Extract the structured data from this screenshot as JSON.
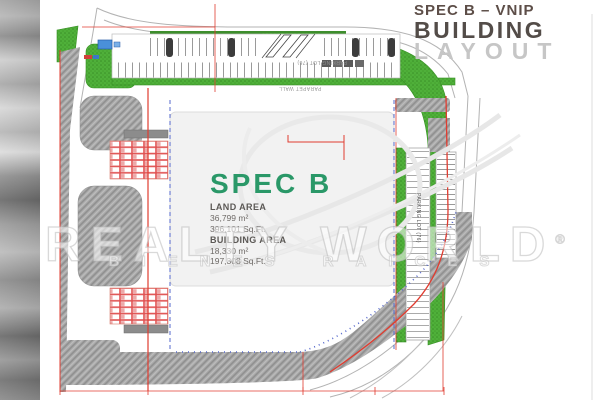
{
  "header": {
    "line1": "SPEC B – VNIP",
    "line2": "BUILDING",
    "line3": "LAYOUT"
  },
  "building_info": {
    "name": "SPEC B",
    "land_area_label": "LAND AREA",
    "land_area_m2": "36,799 m²",
    "land_area_sqft": "396,101 Sq.Ft.",
    "building_area_label": "BUILDING AREA",
    "building_area_m2": "18,330 m²",
    "building_area_sqft": "197,308 Sq.Ft."
  },
  "watermark": {
    "brand": "REALTY WORLD",
    "registered": "®",
    "tagline": "BIENES RAICES"
  },
  "plan_labels": {
    "parking_top": "PARKING LOT (76)",
    "parapet_wall": "PARAPET WALL",
    "parking_right": "PARKING LOT (76)"
  },
  "colors": {
    "landscaping_green": "#4aab35",
    "pavement_hatch_gray": "#a4a4a4",
    "boundary_red": "#e03c30",
    "building_wall_blue": "#5568cc",
    "spec_name_teal": "#2a9868",
    "title_dark": "#534c48",
    "layout_light_gray": "#c6c6c6"
  }
}
